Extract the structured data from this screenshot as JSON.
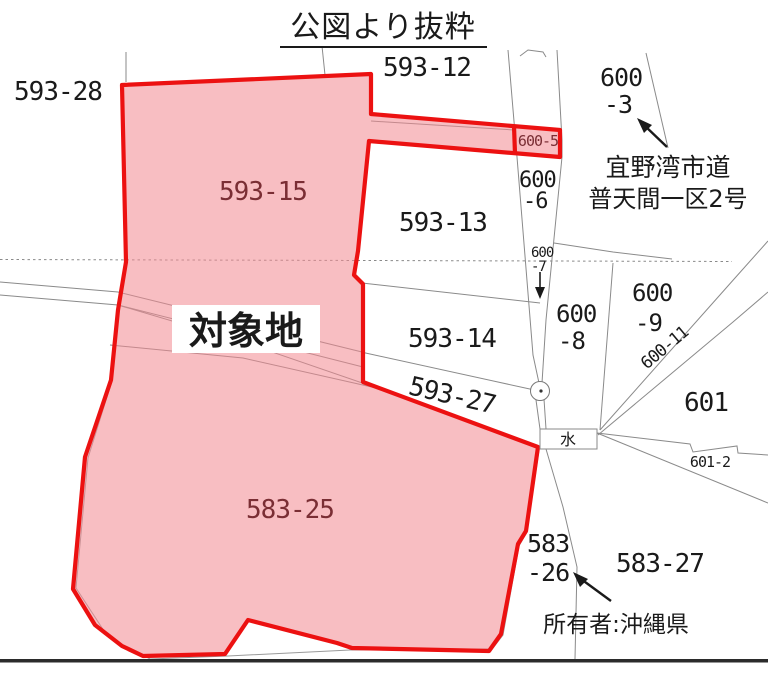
{
  "title": "公図より抜粋",
  "target_label": "対象地",
  "owner_note": "所有者:沖縄県",
  "water_mark": "水",
  "road_name": {
    "line1": "宜野湾市道",
    "line2": "普天間一区2号"
  },
  "parcels": {
    "p593_12": "593-12",
    "p593_28": "593-28",
    "p593_15": "593-15",
    "p593_13": "593-13",
    "p593_14": "593-14",
    "p593_27": "593-27",
    "p583_25": "583-25",
    "p583_27": "583-27",
    "p601": "601",
    "p601_2": "601-2",
    "p600_5": "600-5",
    "p600_11": "600-11",
    "p600_3": {
      "l1": "600",
      "l2": "-3"
    },
    "p600_6": {
      "l1": "600",
      "l2": "-6"
    },
    "p600_7": {
      "l1": "600",
      "l2": "-7"
    },
    "p600_8": {
      "l1": "600",
      "l2": "-8"
    },
    "p600_9": {
      "l1": "600",
      "l2": "-9"
    },
    "p583_26": {
      "l1": "583",
      "l2": "-26"
    }
  },
  "colors": {
    "highlight_border": "#ec1111",
    "highlight_fill": "#f8bec2",
    "label_on_highlight": "#7a2e34",
    "boundary_line": "#8a8a8a",
    "text": "#1a1a1a"
  }
}
